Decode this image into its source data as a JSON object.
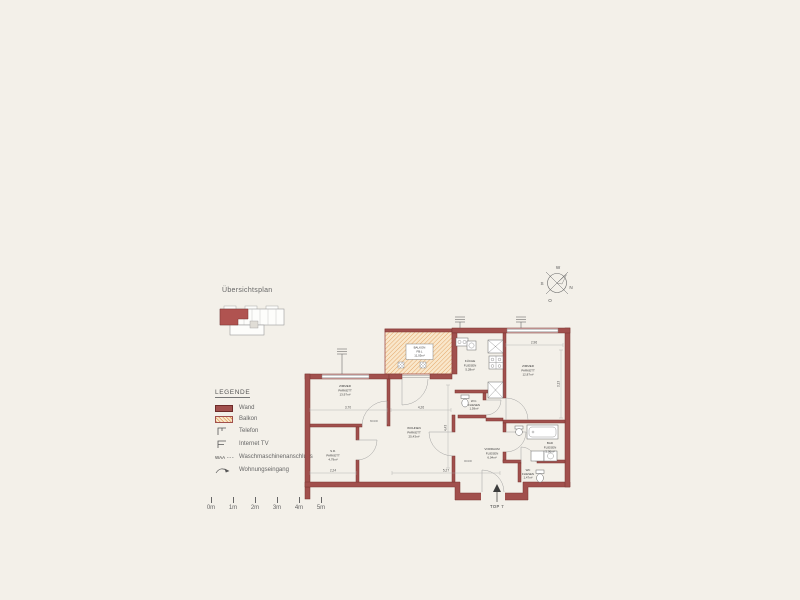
{
  "overview": {
    "title": "Übersichtsplan"
  },
  "legend": {
    "title": "LEGENDE",
    "items": [
      {
        "label": "Wand"
      },
      {
        "label": "Balkon"
      },
      {
        "label": "Telefon"
      },
      {
        "label": "Internet TV"
      },
      {
        "label": "Waschmaschinenanschluss",
        "prefix": "WAA"
      },
      {
        "label": "Wohnungseingang"
      }
    ]
  },
  "scalebar": {
    "labels": [
      "0m",
      "1m",
      "2m",
      "3m",
      "4m",
      "5m"
    ]
  },
  "compass": {
    "n": "N",
    "s": "S",
    "w": "W",
    "o": "O"
  },
  "plan": {
    "unit_label": "TOP 7",
    "rooms": [
      {
        "id": "balkon",
        "name": "BALKON",
        "floor": "FB:L",
        "area": "11,05m²"
      },
      {
        "id": "zimmer-west",
        "name": "ZIMMER",
        "floor": "PARKETT",
        "area": "13,97m²"
      },
      {
        "id": "kueche",
        "name": "KÜCHE",
        "floor": "FLIESEN",
        "area": "5,28m²"
      },
      {
        "id": "zimmer-ost",
        "name": "ZIMMER",
        "floor": "PARKETT",
        "area": "12,87m²"
      },
      {
        "id": "wohnen",
        "name": "WOHNEN",
        "floor": "PARKETT",
        "area": "25,43m²"
      },
      {
        "id": "wc-klein",
        "name": "W.C.",
        "floor": "FLIESEN",
        "area": "1,59m²"
      },
      {
        "id": "schrankraum",
        "name": "S.R.",
        "floor": "PARKETT",
        "area": "4,79m²"
      },
      {
        "id": "vorraum",
        "name": "VORRAUM",
        "floor": "FLIESEN",
        "area": "6,04m²"
      },
      {
        "id": "bad",
        "name": "BAD",
        "floor": "FLIESEN",
        "area": "5,06m²"
      },
      {
        "id": "wc",
        "name": "WC",
        "floor": "FLIESEN",
        "area": "1,47m²"
      }
    ],
    "dimensions": [
      "3,70",
      "4,26",
      "2,24",
      "5,27",
      "2,96",
      "3,13",
      "4,43"
    ],
    "door_labels": [
      "80/200",
      "90/200"
    ]
  },
  "colors": {
    "wall": "#a1504d",
    "balcony_fill": "#f9e7cb",
    "balcony_hatch": "#e2a05f",
    "background": "#f3f0e9"
  }
}
